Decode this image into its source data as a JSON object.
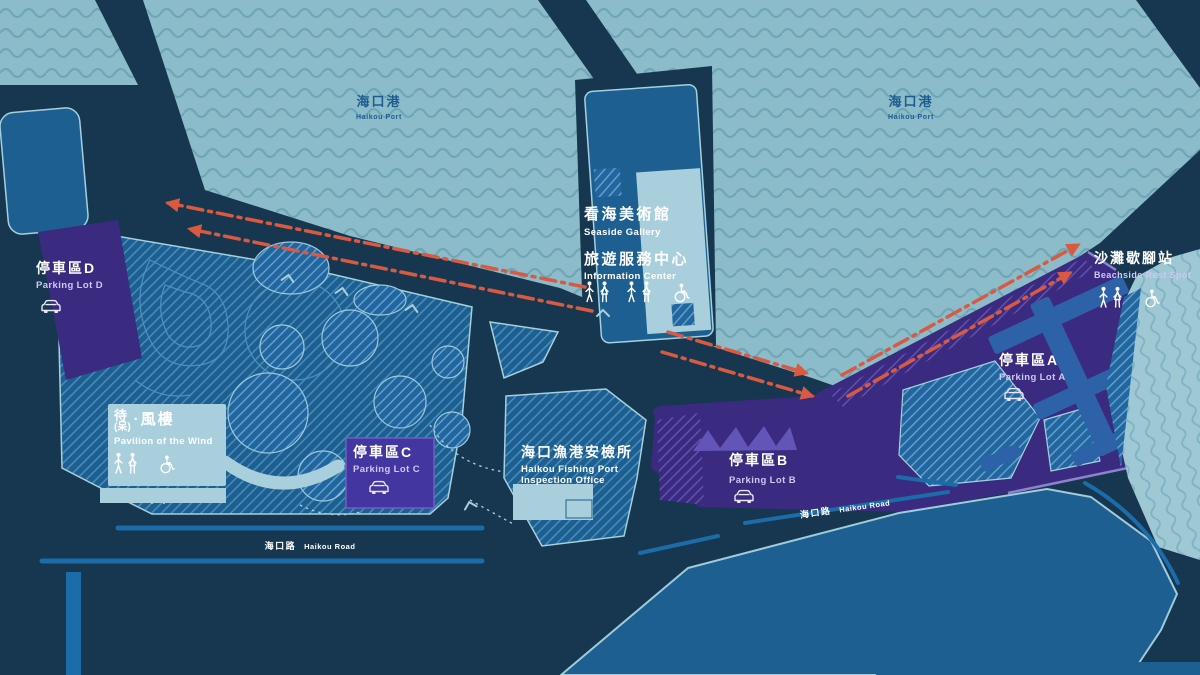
{
  "ports": [
    {
      "zh": "海口港",
      "en": "Haikou Port"
    },
    {
      "zh": "海口港",
      "en": "Haikou Port"
    }
  ],
  "gallery": {
    "zh1": "看海美術館",
    "en1": "Seaside Gallery",
    "zh2": "旅遊服務中心",
    "en2": "Information Center"
  },
  "pavilion": {
    "zh_main": "待",
    "zh_alt": "(呆)",
    "zh_rest": "·風樓",
    "en": "Pavilion of the Wind"
  },
  "inspection": {
    "zh": "海口漁港安檢所",
    "en1": "Haikou Fishing Port",
    "en2": "Inspection Office"
  },
  "rest_spot": {
    "zh": "沙灘歇腳站",
    "en": "Beachside Rest Spot"
  },
  "parking": {
    "d": {
      "zh": "停車區D",
      "en": "Parking Lot D"
    },
    "c": {
      "zh": "停車區C",
      "en": "Parking Lot C"
    },
    "b": {
      "zh": "停車區B",
      "en": "Parking Lot B"
    },
    "a": {
      "zh": "停車區A",
      "en": "Parking Lot A"
    }
  },
  "roads": [
    {
      "zh": "海口路",
      "en": "Haikou Road"
    },
    {
      "zh": "海口路",
      "en": "Haikou Road"
    }
  ],
  "colors": {
    "navy": "#16374F",
    "water": "#8CBCC9",
    "wave": "#6FA6B5",
    "block": "#1D5F90",
    "block2": "#2166A0",
    "light": "#A9CFDD",
    "outline": "#A5D0DE",
    "purple": "#3A2B80",
    "purple_bright": "#4336A0",
    "lav": "#8E82CE",
    "red": "#D95941",
    "stripe": "#1B6CA8",
    "text_blue": "#1D5C8F",
    "hatch_line": "#4E90BE",
    "hatch_line2": "#6FA8CC",
    "hatch_purple_line": "#6757B5",
    "saw": "#6355B8",
    "comb": "#2E62A8",
    "beach": "#9DC8D4",
    "beach_wave": "#7FB2C2",
    "en_lav": "#CFC8F2"
  }
}
